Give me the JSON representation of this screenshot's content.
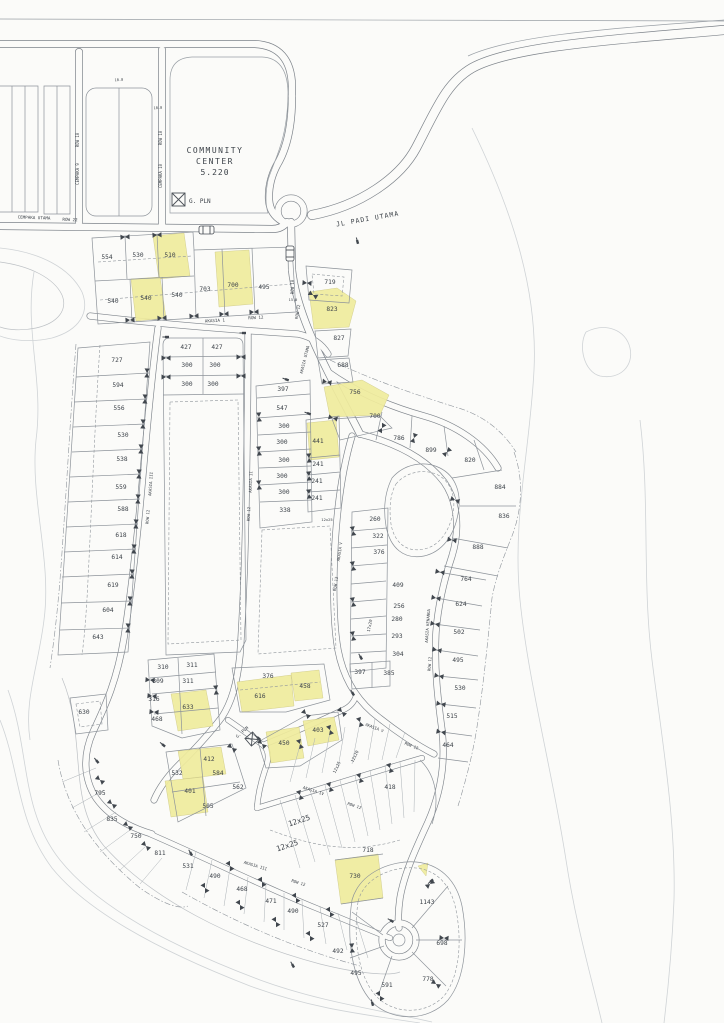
{
  "colors": {
    "highlight": "#f0ec9d",
    "line": "#8d939a",
    "road_edge": "#7d838a",
    "paper": "#fbfbf9",
    "text": "#3c4249"
  },
  "map": {
    "labels": [
      {
        "t": "COMMUNITY",
        "x": 215,
        "y": 153,
        "s": 8,
        "ls": 1.5,
        "k": "land"
      },
      {
        "t": "CENTER",
        "x": 215,
        "y": 164,
        "s": 8,
        "ls": 1.5,
        "k": "land"
      },
      {
        "t": "5.220",
        "x": 215,
        "y": 175,
        "s": 8,
        "ls": 1,
        "k": "land"
      },
      {
        "t": "G. PLN",
        "x": 189,
        "y": 203,
        "s": 6,
        "k": "land",
        "a": "s"
      },
      {
        "t": "G. PLN",
        "x": 243,
        "y": 733,
        "r": -42,
        "s": 4.2,
        "k": "street"
      },
      {
        "t": "JL  PADI UTAMA",
        "x": 368,
        "y": 221,
        "r": -10,
        "s": 6.5,
        "ls": 1,
        "k": "land"
      },
      {
        "t": "CEMPAKA UTAMA",
        "x": 34,
        "y": 219,
        "r": 2,
        "s": 4.2,
        "k": "street"
      },
      {
        "t": "ROW 22",
        "x": 70,
        "y": 221,
        "r": 2,
        "s": 4.2,
        "k": "street"
      },
      {
        "t": "ROW 10",
        "x": 79,
        "y": 140,
        "r": -90,
        "s": 4,
        "k": "street"
      },
      {
        "t": "CEMPAKA 9",
        "x": 79,
        "y": 174,
        "r": -90,
        "s": 4,
        "k": "street"
      },
      {
        "t": "ROW 10",
        "x": 162,
        "y": 138,
        "r": -90,
        "s": 4,
        "k": "street"
      },
      {
        "t": "CEMPAKA 10",
        "x": 162,
        "y": 176,
        "r": -90,
        "s": 4,
        "k": "street"
      },
      {
        "t": "ROW 10",
        "x": 294,
        "y": 287,
        "r": -90,
        "s": 4,
        "k": "street"
      },
      {
        "t": "ROW 12",
        "x": 299,
        "y": 312,
        "r": -80,
        "s": 4,
        "k": "street"
      },
      {
        "t": "AKASIA 1",
        "x": 215,
        "y": 322,
        "r": -3,
        "s": 4.2,
        "k": "street"
      },
      {
        "t": "ROW 12",
        "x": 256,
        "y": 319,
        "r": -3,
        "s": 4.2,
        "k": "street"
      },
      {
        "t": "AKASIA UTAMA",
        "x": 306,
        "y": 360,
        "r": -76,
        "s": 4,
        "k": "street"
      },
      {
        "t": "AKASIA III",
        "x": 152,
        "y": 484,
        "r": -86,
        "s": 4,
        "k": "street"
      },
      {
        "t": "ROW 12",
        "x": 149,
        "y": 517,
        "r": -86,
        "s": 4,
        "k": "street"
      },
      {
        "t": "AKASIA II",
        "x": 252,
        "y": 482,
        "r": -88,
        "s": 4,
        "k": "street"
      },
      {
        "t": "ROW 12",
        "x": 250,
        "y": 514,
        "r": -88,
        "s": 4,
        "k": "street"
      },
      {
        "t": "AKASIA V",
        "x": 341,
        "y": 552,
        "r": -82,
        "s": 4,
        "k": "street"
      },
      {
        "t": "ROW 12",
        "x": 337,
        "y": 584,
        "r": -82,
        "s": 4,
        "k": "street"
      },
      {
        "t": "AKASIA KENANGA",
        "x": 429,
        "y": 626,
        "r": -86,
        "s": 4,
        "k": "street"
      },
      {
        "t": "ROW 12",
        "x": 431,
        "y": 664,
        "r": -86,
        "s": 4,
        "k": "street"
      },
      {
        "t": "AKASIA V",
        "x": 374,
        "y": 729,
        "r": 21,
        "s": 4,
        "k": "street"
      },
      {
        "t": "ROW 12",
        "x": 411,
        "y": 747,
        "r": 21,
        "s": 4,
        "k": "street"
      },
      {
        "t": "AKASIA IV",
        "x": 313,
        "y": 792,
        "r": 18,
        "s": 4,
        "k": "street"
      },
      {
        "t": "ROW 12",
        "x": 354,
        "y": 807,
        "r": 18,
        "s": 4,
        "k": "street"
      },
      {
        "t": "AKASIA III",
        "x": 255,
        "y": 867,
        "r": 17,
        "s": 4,
        "k": "street"
      },
      {
        "t": "ROW 12",
        "x": 298,
        "y": 884,
        "r": 17,
        "s": 4,
        "k": "street"
      },
      {
        "t": "10.0",
        "x": 119,
        "y": 81,
        "r": -3,
        "s": 3.6,
        "k": "dim"
      },
      {
        "t": "10.0",
        "x": 158,
        "y": 109,
        "r": -3,
        "s": 3.6,
        "k": "dim"
      },
      {
        "t": "15.0",
        "x": 293,
        "y": 301,
        "s": 3.6,
        "k": "dim"
      },
      {
        "t": "12x25",
        "x": 327,
        "y": 521,
        "s": 3.8,
        "k": "dim"
      },
      {
        "t": "17x20",
        "x": 371,
        "y": 626,
        "r": -78,
        "s": 4.2,
        "k": "dim"
      },
      {
        "t": "12x20",
        "x": 356,
        "y": 757,
        "r": -64,
        "s": 4.2,
        "k": "dim"
      },
      {
        "t": "12x25",
        "x": 338,
        "y": 768,
        "r": -64,
        "s": 4.2,
        "k": "dim"
      },
      {
        "t": "12x25",
        "x": 300,
        "y": 823,
        "r": -18,
        "s": 7.5,
        "k": "dimbig"
      },
      {
        "t": "12x25",
        "x": 288,
        "y": 848,
        "r": -18,
        "s": 7.5,
        "k": "dimbig"
      },
      {
        "t": "554",
        "x": 107,
        "y": 259,
        "k": "lot"
      },
      {
        "t": "530",
        "x": 138,
        "y": 257,
        "k": "lot"
      },
      {
        "t": "510",
        "x": 170,
        "y": 257,
        "k": "lot"
      },
      {
        "t": "540",
        "x": 113,
        "y": 303,
        "k": "lot"
      },
      {
        "t": "540",
        "x": 146,
        "y": 300,
        "k": "lot"
      },
      {
        "t": "540",
        "x": 177,
        "y": 297,
        "k": "lot"
      },
      {
        "t": "703",
        "x": 205,
        "y": 291,
        "k": "lot"
      },
      {
        "t": "700",
        "x": 233,
        "y": 287,
        "k": "lot"
      },
      {
        "t": "495",
        "x": 264,
        "y": 289,
        "k": "lot"
      },
      {
        "t": "719",
        "x": 330,
        "y": 284,
        "k": "lot"
      },
      {
        "t": "823",
        "x": 332,
        "y": 311,
        "k": "lot"
      },
      {
        "t": "827",
        "x": 339,
        "y": 340,
        "k": "lot"
      },
      {
        "t": "688",
        "x": 343,
        "y": 367,
        "k": "lot"
      },
      {
        "t": "756",
        "x": 355,
        "y": 394,
        "k": "lot"
      },
      {
        "t": "700",
        "x": 375,
        "y": 418,
        "k": "lot"
      },
      {
        "t": "786",
        "x": 399,
        "y": 440,
        "k": "lot"
      },
      {
        "t": "899",
        "x": 431,
        "y": 452,
        "k": "lot"
      },
      {
        "t": "820",
        "x": 470,
        "y": 462,
        "k": "lot"
      },
      {
        "t": "884",
        "x": 500,
        "y": 489,
        "k": "lot"
      },
      {
        "t": "836",
        "x": 504,
        "y": 518,
        "k": "lot"
      },
      {
        "t": "888",
        "x": 478,
        "y": 549,
        "k": "lot"
      },
      {
        "t": "764",
        "x": 466,
        "y": 581,
        "k": "lot"
      },
      {
        "t": "624",
        "x": 461,
        "y": 606,
        "k": "lot"
      },
      {
        "t": "502",
        "x": 459,
        "y": 634,
        "k": "lot"
      },
      {
        "t": "495",
        "x": 458,
        "y": 662,
        "k": "lot"
      },
      {
        "t": "530",
        "x": 460,
        "y": 690,
        "k": "lot"
      },
      {
        "t": "515",
        "x": 452,
        "y": 718,
        "k": "lot"
      },
      {
        "t": "464",
        "x": 448,
        "y": 747,
        "k": "lot"
      },
      {
        "t": "427",
        "x": 186,
        "y": 349,
        "k": "lot"
      },
      {
        "t": "427",
        "x": 217,
        "y": 349,
        "k": "lot"
      },
      {
        "t": "300",
        "x": 187,
        "y": 367,
        "k": "lot"
      },
      {
        "t": "300",
        "x": 215,
        "y": 367,
        "k": "lot"
      },
      {
        "t": "300",
        "x": 187,
        "y": 386,
        "k": "lot"
      },
      {
        "t": "300",
        "x": 213,
        "y": 386,
        "k": "lot"
      },
      {
        "t": "397",
        "x": 283,
        "y": 391,
        "k": "lot"
      },
      {
        "t": "547",
        "x": 282,
        "y": 410,
        "k": "lot"
      },
      {
        "t": "300",
        "x": 284,
        "y": 428,
        "k": "lot"
      },
      {
        "t": "300",
        "x": 282,
        "y": 444,
        "k": "lot"
      },
      {
        "t": "300",
        "x": 284,
        "y": 462,
        "k": "lot"
      },
      {
        "t": "300",
        "x": 282,
        "y": 478,
        "k": "lot"
      },
      {
        "t": "300",
        "x": 284,
        "y": 494,
        "k": "lot"
      },
      {
        "t": "338",
        "x": 285,
        "y": 512,
        "k": "lot"
      },
      {
        "t": "441",
        "x": 318,
        "y": 443,
        "k": "lot"
      },
      {
        "t": "241",
        "x": 318,
        "y": 466,
        "k": "lot"
      },
      {
        "t": "241",
        "x": 317,
        "y": 483,
        "k": "lot"
      },
      {
        "t": "241",
        "x": 317,
        "y": 500,
        "k": "lot"
      },
      {
        "t": "260",
        "x": 375,
        "y": 521,
        "k": "lot"
      },
      {
        "t": "322",
        "x": 378,
        "y": 538,
        "k": "lot"
      },
      {
        "t": "376",
        "x": 379,
        "y": 554,
        "k": "lot"
      },
      {
        "t": "409",
        "x": 398,
        "y": 587,
        "k": "lot"
      },
      {
        "t": "256",
        "x": 399,
        "y": 608,
        "k": "lot"
      },
      {
        "t": "280",
        "x": 397,
        "y": 621,
        "k": "lot"
      },
      {
        "t": "293",
        "x": 397,
        "y": 638,
        "k": "lot"
      },
      {
        "t": "304",
        "x": 398,
        "y": 656,
        "k": "lot"
      },
      {
        "t": "397",
        "x": 360,
        "y": 674,
        "k": "lot"
      },
      {
        "t": "385",
        "x": 389,
        "y": 675,
        "k": "lot"
      },
      {
        "t": "727",
        "x": 117,
        "y": 362,
        "k": "lot"
      },
      {
        "t": "594",
        "x": 118,
        "y": 387,
        "k": "lot"
      },
      {
        "t": "556",
        "x": 119,
        "y": 410,
        "k": "lot"
      },
      {
        "t": "530",
        "x": 123,
        "y": 437,
        "k": "lot"
      },
      {
        "t": "538",
        "x": 122,
        "y": 461,
        "k": "lot"
      },
      {
        "t": "559",
        "x": 121,
        "y": 489,
        "k": "lot"
      },
      {
        "t": "588",
        "x": 123,
        "y": 511,
        "k": "lot"
      },
      {
        "t": "618",
        "x": 121,
        "y": 537,
        "k": "lot"
      },
      {
        "t": "614",
        "x": 117,
        "y": 559,
        "k": "lot"
      },
      {
        "t": "619",
        "x": 113,
        "y": 587,
        "k": "lot"
      },
      {
        "t": "604",
        "x": 108,
        "y": 612,
        "k": "lot"
      },
      {
        "t": "643",
        "x": 98,
        "y": 639,
        "k": "lot"
      },
      {
        "t": "630",
        "x": 84,
        "y": 714,
        "k": "lot"
      },
      {
        "t": "310",
        "x": 163,
        "y": 669,
        "k": "lot"
      },
      {
        "t": "311",
        "x": 192,
        "y": 667,
        "k": "lot"
      },
      {
        "t": "309",
        "x": 158,
        "y": 683,
        "k": "lot"
      },
      {
        "t": "311",
        "x": 188,
        "y": 683,
        "k": "lot"
      },
      {
        "t": "316",
        "x": 154,
        "y": 701,
        "k": "lot"
      },
      {
        "t": "633",
        "x": 188,
        "y": 709,
        "k": "lot"
      },
      {
        "t": "468",
        "x": 157,
        "y": 721,
        "k": "lot"
      },
      {
        "t": "376",
        "x": 268,
        "y": 678,
        "k": "lot"
      },
      {
        "t": "458",
        "x": 305,
        "y": 688,
        "k": "lot"
      },
      {
        "t": "616",
        "x": 260,
        "y": 698,
        "k": "lot"
      },
      {
        "t": "403",
        "x": 318,
        "y": 732,
        "k": "lot"
      },
      {
        "t": "450",
        "x": 284,
        "y": 745,
        "k": "lot"
      },
      {
        "t": "412",
        "x": 209,
        "y": 761,
        "k": "lot"
      },
      {
        "t": "532",
        "x": 177,
        "y": 775,
        "k": "lot"
      },
      {
        "t": "584",
        "x": 218,
        "y": 775,
        "k": "lot"
      },
      {
        "t": "562",
        "x": 238,
        "y": 789,
        "k": "lot"
      },
      {
        "t": "401",
        "x": 190,
        "y": 793,
        "k": "lot"
      },
      {
        "t": "505",
        "x": 208,
        "y": 808,
        "k": "lot"
      },
      {
        "t": "418",
        "x": 390,
        "y": 789,
        "k": "lot"
      },
      {
        "t": "718",
        "x": 368,
        "y": 852,
        "k": "lot"
      },
      {
        "t": "730",
        "x": 355,
        "y": 878,
        "k": "lot"
      },
      {
        "t": "795",
        "x": 100,
        "y": 795,
        "k": "lot"
      },
      {
        "t": "835",
        "x": 112,
        "y": 821,
        "k": "lot"
      },
      {
        "t": "750",
        "x": 136,
        "y": 838,
        "k": "lot"
      },
      {
        "t": "811",
        "x": 160,
        "y": 855,
        "k": "lot"
      },
      {
        "t": "531",
        "x": 188,
        "y": 868,
        "k": "lot"
      },
      {
        "t": "490",
        "x": 215,
        "y": 878,
        "k": "lot"
      },
      {
        "t": "468",
        "x": 242,
        "y": 891,
        "k": "lot"
      },
      {
        "t": "471",
        "x": 271,
        "y": 903,
        "k": "lot"
      },
      {
        "t": "490",
        "x": 293,
        "y": 913,
        "k": "lot"
      },
      {
        "t": "527",
        "x": 323,
        "y": 927,
        "k": "lot"
      },
      {
        "t": "492",
        "x": 338,
        "y": 953,
        "k": "lot"
      },
      {
        "t": "495",
        "x": 356,
        "y": 975,
        "k": "lot"
      },
      {
        "t": "591",
        "x": 387,
        "y": 987,
        "k": "lot"
      },
      {
        "t": "1143",
        "x": 427,
        "y": 904,
        "k": "lot"
      },
      {
        "t": "698",
        "x": 442,
        "y": 945,
        "k": "lot"
      },
      {
        "t": "778",
        "x": 428,
        "y": 981,
        "k": "lot"
      }
    ]
  }
}
